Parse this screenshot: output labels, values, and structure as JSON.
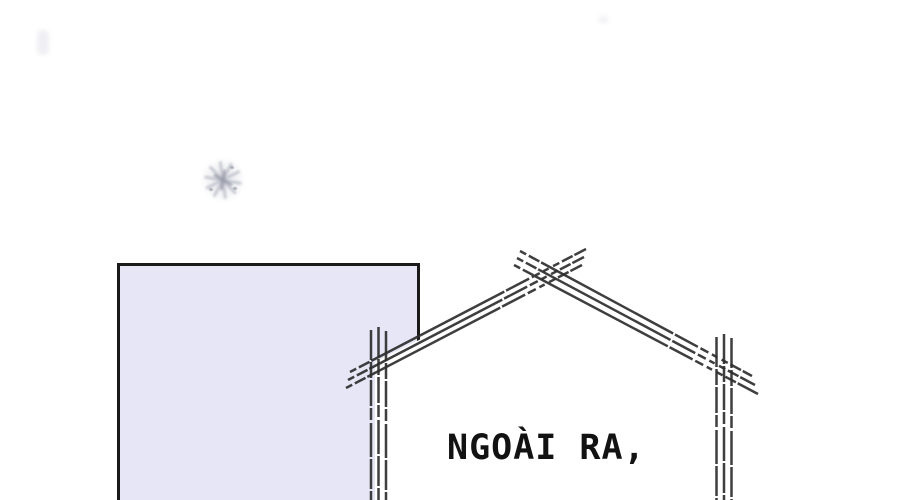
{
  "panel": {
    "caption": "NGOÀI RA,",
    "colors": {
      "background": "#ffffff",
      "building_fill": "#e6e6f6",
      "building_border": "#1a1a1a",
      "sketch_line": "#2e2e2e",
      "caption_text": "#121212",
      "splatter": "#b9bcc7",
      "splatter_dark": "#989ca8"
    }
  }
}
